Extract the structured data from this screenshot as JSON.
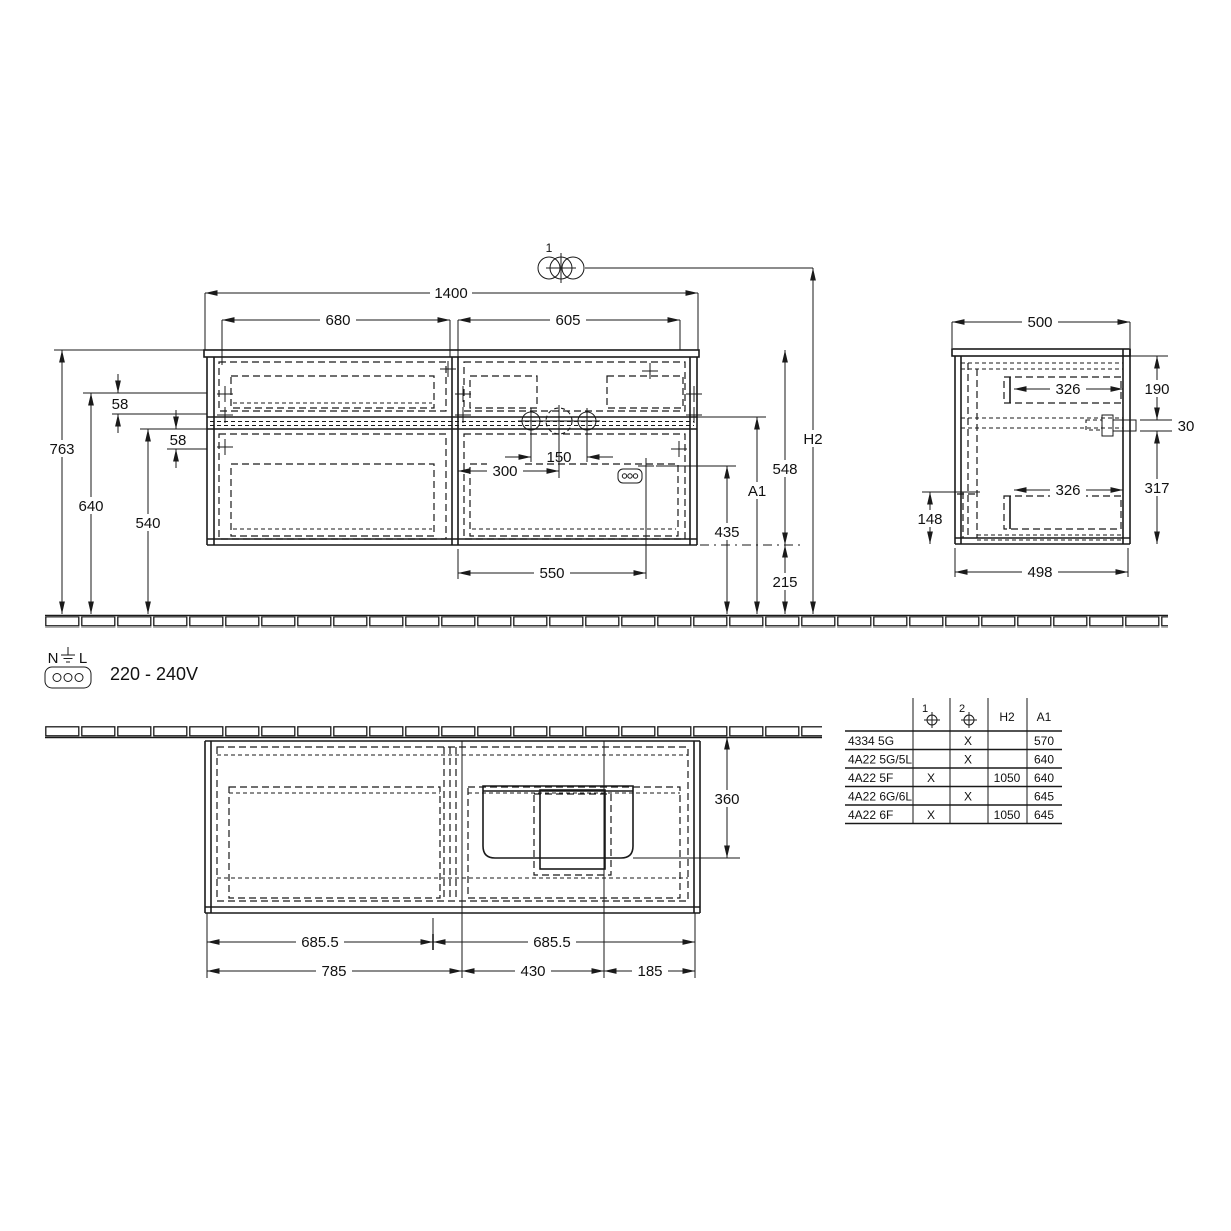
{
  "front": {
    "callout": "1",
    "w_total": "1400",
    "w_left": "680",
    "w_right": "605",
    "off_top": "58",
    "off_bot": "58",
    "h_total": "763",
    "h_640": "640",
    "h_540": "540",
    "faucet_span": "150",
    "faucet_off": "300",
    "drawer_w": "550",
    "h_435": "435",
    "h_215": "215",
    "h_548": "548",
    "a1": "A1",
    "h2": "H2"
  },
  "side": {
    "w_top": "500",
    "h_190": "190",
    "d_326_top": "326",
    "bracket_30": "30",
    "h_317": "317",
    "h_148": "148",
    "d_326_bot": "326",
    "w_bot": "498"
  },
  "plan": {
    "d_360": "360",
    "w_685_l": "685.5",
    "w_685_r": "685.5",
    "w_785": "785",
    "w_430": "430",
    "w_185": "185"
  },
  "power": {
    "n": "N",
    "l": "L",
    "voltage": "220 - 240V"
  },
  "table": {
    "h_c1": "1",
    "h_c2": "2",
    "h_h2": "H2",
    "h_a1": "A1",
    "rows": [
      {
        "model": "4334 5G",
        "c1": "",
        "c2": "X",
        "h2": "",
        "a1": "570"
      },
      {
        "model": "4A22 5G/5L",
        "c1": "",
        "c2": "X",
        "h2": "",
        "a1": "640"
      },
      {
        "model": "4A22 5F",
        "c1": "X",
        "c2": "",
        "h2": "1050",
        "a1": "640"
      },
      {
        "model": "4A22 6G/6L",
        "c1": "",
        "c2": "X",
        "h2": "",
        "a1": "645"
      },
      {
        "model": "4A22 6F",
        "c1": "X",
        "c2": "",
        "h2": "1050",
        "a1": "645"
      }
    ]
  }
}
